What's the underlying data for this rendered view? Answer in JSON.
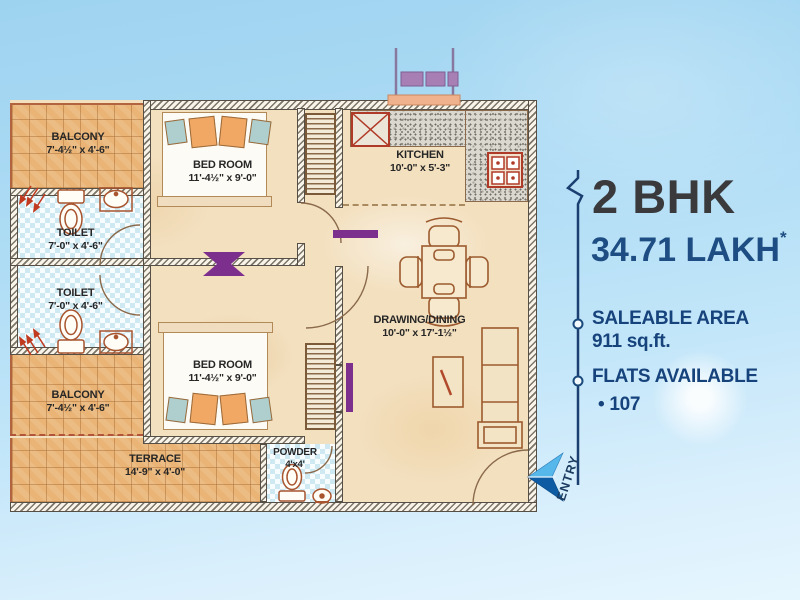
{
  "flyer": {
    "panel": {
      "bhk_title": "2 BHK",
      "price": "34.71 LAKH",
      "price_superscript": "*",
      "features": [
        {
          "label": "SALEABLE AREA",
          "value": "911 sq.ft."
        },
        {
          "label": "FLATS AVAILABLE",
          "value": "• 107"
        }
      ]
    },
    "entry_label": "ENTRY",
    "plan": {
      "rooms": [
        {
          "id": "balcony-top",
          "name": "BALCONY",
          "dims": "7'-4½\" x 4'-6\""
        },
        {
          "id": "toilet-top",
          "name": "TOILET",
          "dims": "7'-0\" x 4'-6\""
        },
        {
          "id": "toilet-bottom",
          "name": "TOILET",
          "dims": "7'-0\" x 4'-6\""
        },
        {
          "id": "balcony-bottom",
          "name": "BALCONY",
          "dims": "7'-4½\" x 4'-6\""
        },
        {
          "id": "terrace",
          "name": "TERRACE",
          "dims": "14'-9\" x 4'-0\""
        },
        {
          "id": "bedroom-top",
          "name": "BED ROOM",
          "dims": "11'-4½\" x 9'-0\""
        },
        {
          "id": "bedroom-bottom",
          "name": "BED ROOM",
          "dims": "11'-4½\" x 9'-0\""
        },
        {
          "id": "kitchen",
          "name": "KITCHEN",
          "dims": "10'-0\" x 5'-3\""
        },
        {
          "id": "drawing-dining",
          "name": "DRAWING/DINING",
          "dims": "10'-0\" x 17'-1½\""
        },
        {
          "id": "powder",
          "name": "POWDER",
          "dims": "4'x4'"
        }
      ]
    },
    "colors": {
      "price_blue": "#1d4d82",
      "bhk_charcoal": "#3a3a3c",
      "accent_line_blue": "#1a3f70",
      "entry_arrow_light": "#55b7ea",
      "entry_arrow_dark": "#0d5ca3",
      "purple_accent": "#7d2f8e",
      "sky_top": "#9ed3f0",
      "sky_bottom": "#e6f6fe"
    },
    "icons": [
      "entry-arrow-icon",
      "double-bed-icon",
      "toilet-wc-icon",
      "washbasin-icon",
      "shower-icon",
      "dining-set-icon",
      "sofa-icon",
      "tv-unit-icon",
      "kitchen-sink-icon",
      "stove-icon",
      "shoe-cabinet-icon",
      "door-swing-arc",
      "window-duct-icon"
    ]
  }
}
